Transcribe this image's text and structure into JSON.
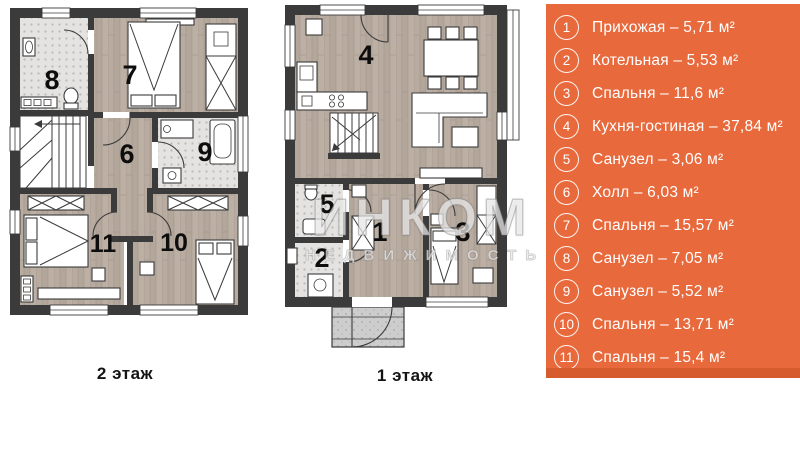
{
  "floor2": {
    "label": "2 этаж",
    "rooms": {
      "bath8": "8",
      "bedroom7": "7",
      "hall6": "6",
      "bath9": "9",
      "bedroom11": "11",
      "bedroom10": "10"
    }
  },
  "floor1": {
    "label": "1 этаж",
    "rooms": {
      "living4": "4",
      "bath5": "5",
      "boiler2": "2",
      "entry1": "1",
      "bedroom3": "3"
    }
  },
  "watermark": {
    "line1": "ИНКОМ",
    "line2": "НЕДВИЖИМОСТЬ"
  },
  "legend": {
    "panel_color": "#e8693c",
    "footer_color": "#d65c2e",
    "text_color": "#ffffff",
    "items": [
      {
        "num": "1",
        "text": "Прихожая – 5,71 м²"
      },
      {
        "num": "2",
        "text": "Котельная – 5,53 м²"
      },
      {
        "num": "3",
        "text": "Спальня – 11,6 м²"
      },
      {
        "num": "4",
        "text": "Кухня-гостиная – 37,84 м²"
      },
      {
        "num": "5",
        "text": "Санузел – 3,06 м²"
      },
      {
        "num": "6",
        "text": "Холл – 6,03 м²"
      },
      {
        "num": "7",
        "text": "Спальня – 15,57 м²"
      },
      {
        "num": "8",
        "text": "Санузел – 7,05 м²"
      },
      {
        "num": "9",
        "text": "Санузел – 5,52 м²"
      },
      {
        "num": "10",
        "text": "Спальня – 13,71 м²"
      },
      {
        "num": "11",
        "text": "Спальня – 15,4 м²"
      }
    ]
  }
}
